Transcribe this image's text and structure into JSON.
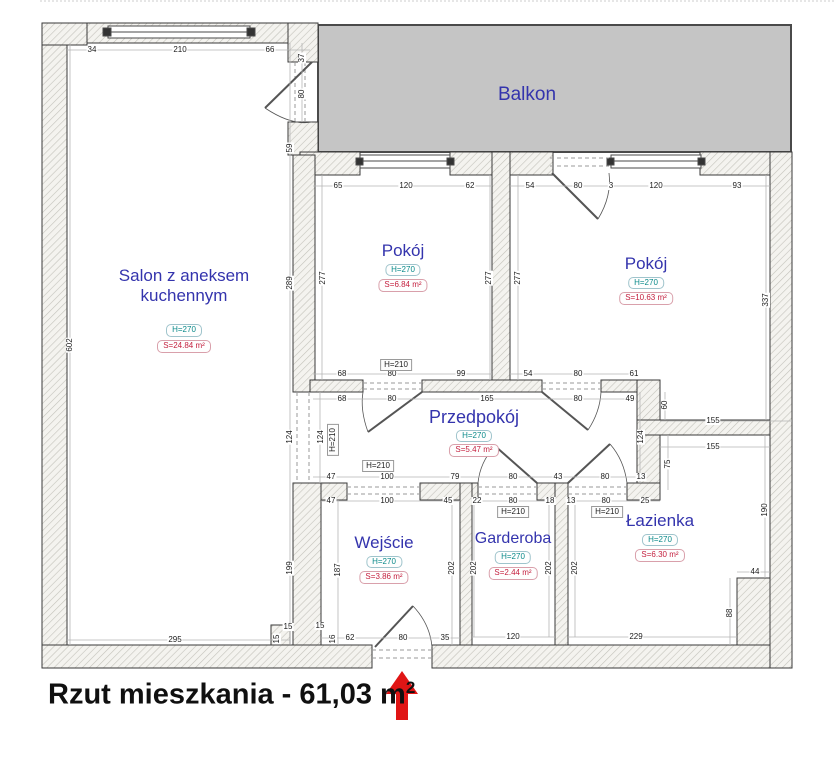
{
  "title": {
    "text": "Rzut mieszkania - 61,03 m",
    "sup": "2"
  },
  "rooms": {
    "balkon": {
      "name": "Balkon"
    },
    "salon": {
      "name": "Salon z aneksem kuchennym",
      "height": "H=270",
      "area": "S=24.84 m²"
    },
    "pokoj1": {
      "name": "Pokój",
      "height": "H=270",
      "area": "S=6.84 m²"
    },
    "pokoj2": {
      "name": "Pokój",
      "height": "H=270",
      "area": "S=10.63 m²"
    },
    "przedpokoj": {
      "name": "Przedpokój",
      "height": "H=270",
      "area": "S=5.47 m²"
    },
    "wejscie": {
      "name": "Wejście",
      "height": "H=270",
      "area": "S=3.86 m²"
    },
    "garderoba": {
      "name": "Garderoba",
      "height": "H=270",
      "area": "S=2.44 m²"
    },
    "lazienka": {
      "name": "Łazienka",
      "height": "H=270",
      "area": "S=6.30 m²"
    }
  },
  "colors": {
    "room_label": "#3434ad",
    "height_label": "#0a8a8a",
    "area_label": "#c41f3e",
    "balcony_fill": "#c5c5c5",
    "arrow": "#e01515",
    "wall_outline": "#3a3a3a"
  },
  "dims": [
    {
      "t": "34",
      "x": 92,
      "y": 50
    },
    {
      "t": "210",
      "x": 180,
      "y": 50
    },
    {
      "t": "66",
      "x": 270,
      "y": 50
    },
    {
      "t": "37",
      "x": 302,
      "y": 58,
      "c": "r"
    },
    {
      "t": "80",
      "x": 302,
      "y": 94,
      "c": "r"
    },
    {
      "t": "59",
      "x": 290,
      "y": 148,
      "c": "r"
    },
    {
      "t": "602",
      "x": 70,
      "y": 345,
      "c": "r"
    },
    {
      "t": "289",
      "x": 290,
      "y": 283,
      "c": "r"
    },
    {
      "t": "277",
      "x": 323,
      "y": 278,
      "c": "r"
    },
    {
      "t": "65",
      "x": 338,
      "y": 186
    },
    {
      "t": "120",
      "x": 406,
      "y": 186
    },
    {
      "t": "62",
      "x": 470,
      "y": 186
    },
    {
      "t": "277",
      "x": 489,
      "y": 278,
      "c": "r"
    },
    {
      "t": "54",
      "x": 530,
      "y": 186
    },
    {
      "t": "80",
      "x": 578,
      "y": 186
    },
    {
      "t": "3",
      "x": 611,
      "y": 186
    },
    {
      "t": "120",
      "x": 656,
      "y": 186
    },
    {
      "t": "93",
      "x": 737,
      "y": 186
    },
    {
      "t": "277",
      "x": 518,
      "y": 278,
      "c": "r"
    },
    {
      "t": "337",
      "x": 766,
      "y": 300,
      "c": "r"
    },
    {
      "t": "68",
      "x": 342,
      "y": 374
    },
    {
      "t": "80",
      "x": 392,
      "y": 374
    },
    {
      "t": "99",
      "x": 461,
      "y": 374
    },
    {
      "t": "H=210",
      "x": 396,
      "y": 365,
      "c": "hb"
    },
    {
      "t": "54",
      "x": 528,
      "y": 374
    },
    {
      "t": "80",
      "x": 578,
      "y": 374
    },
    {
      "t": "61",
      "x": 634,
      "y": 374
    },
    {
      "t": "68",
      "x": 342,
      "y": 399
    },
    {
      "t": "80",
      "x": 392,
      "y": 399
    },
    {
      "t": "165",
      "x": 487,
      "y": 399
    },
    {
      "t": "80",
      "x": 578,
      "y": 399
    },
    {
      "t": "49",
      "x": 630,
      "y": 399
    },
    {
      "t": "124",
      "x": 290,
      "y": 437,
      "c": "r"
    },
    {
      "t": "124",
      "x": 321,
      "y": 437,
      "c": "r"
    },
    {
      "t": "H=210",
      "x": 333,
      "y": 440,
      "c": "hbr"
    },
    {
      "t": "124",
      "x": 641,
      "y": 437,
      "c": "r"
    },
    {
      "t": "60",
      "x": 665,
      "y": 405,
      "c": "r"
    },
    {
      "t": "155",
      "x": 713,
      "y": 421
    },
    {
      "t": "155",
      "x": 713,
      "y": 447
    },
    {
      "t": "75",
      "x": 668,
      "y": 464,
      "c": "r"
    },
    {
      "t": "47",
      "x": 331,
      "y": 477
    },
    {
      "t": "100",
      "x": 387,
      "y": 477
    },
    {
      "t": "79",
      "x": 455,
      "y": 477
    },
    {
      "t": "80",
      "x": 513,
      "y": 477
    },
    {
      "t": "43",
      "x": 558,
      "y": 477
    },
    {
      "t": "80",
      "x": 605,
      "y": 477
    },
    {
      "t": "13",
      "x": 641,
      "y": 477
    },
    {
      "t": "H=210",
      "x": 378,
      "y": 466,
      "c": "hb"
    },
    {
      "t": "47",
      "x": 331,
      "y": 501
    },
    {
      "t": "100",
      "x": 387,
      "y": 501
    },
    {
      "t": "45",
      "x": 448,
      "y": 501
    },
    {
      "t": "22",
      "x": 477,
      "y": 501
    },
    {
      "t": "80",
      "x": 513,
      "y": 501
    },
    {
      "t": "18",
      "x": 550,
      "y": 501
    },
    {
      "t": "H=210",
      "x": 513,
      "y": 512,
      "c": "hb"
    },
    {
      "t": "13",
      "x": 571,
      "y": 501
    },
    {
      "t": "80",
      "x": 606,
      "y": 501
    },
    {
      "t": "25",
      "x": 645,
      "y": 501
    },
    {
      "t": "H=210",
      "x": 607,
      "y": 512,
      "c": "hb"
    },
    {
      "t": "199",
      "x": 290,
      "y": 568,
      "c": "r"
    },
    {
      "t": "187",
      "x": 338,
      "y": 570,
      "c": "r"
    },
    {
      "t": "202",
      "x": 452,
      "y": 568,
      "c": "r"
    },
    {
      "t": "202",
      "x": 474,
      "y": 568,
      "c": "r"
    },
    {
      "t": "202",
      "x": 549,
      "y": 568,
      "c": "r"
    },
    {
      "t": "202",
      "x": 575,
      "y": 568,
      "c": "r"
    },
    {
      "t": "190",
      "x": 765,
      "y": 510,
      "c": "r"
    },
    {
      "t": "44",
      "x": 755,
      "y": 572
    },
    {
      "t": "88",
      "x": 730,
      "y": 613,
      "c": "r"
    },
    {
      "t": "295",
      "x": 175,
      "y": 640
    },
    {
      "t": "15",
      "x": 288,
      "y": 627
    },
    {
      "t": "15",
      "x": 277,
      "y": 639,
      "c": "r"
    },
    {
      "t": "15",
      "x": 320,
      "y": 626
    },
    {
      "t": "16",
      "x": 333,
      "y": 639,
      "c": "r"
    },
    {
      "t": "62",
      "x": 350,
      "y": 638
    },
    {
      "t": "80",
      "x": 403,
      "y": 638
    },
    {
      "t": "35",
      "x": 445,
      "y": 638
    },
    {
      "t": "120",
      "x": 513,
      "y": 637
    },
    {
      "t": "229",
      "x": 636,
      "y": 637
    }
  ]
}
